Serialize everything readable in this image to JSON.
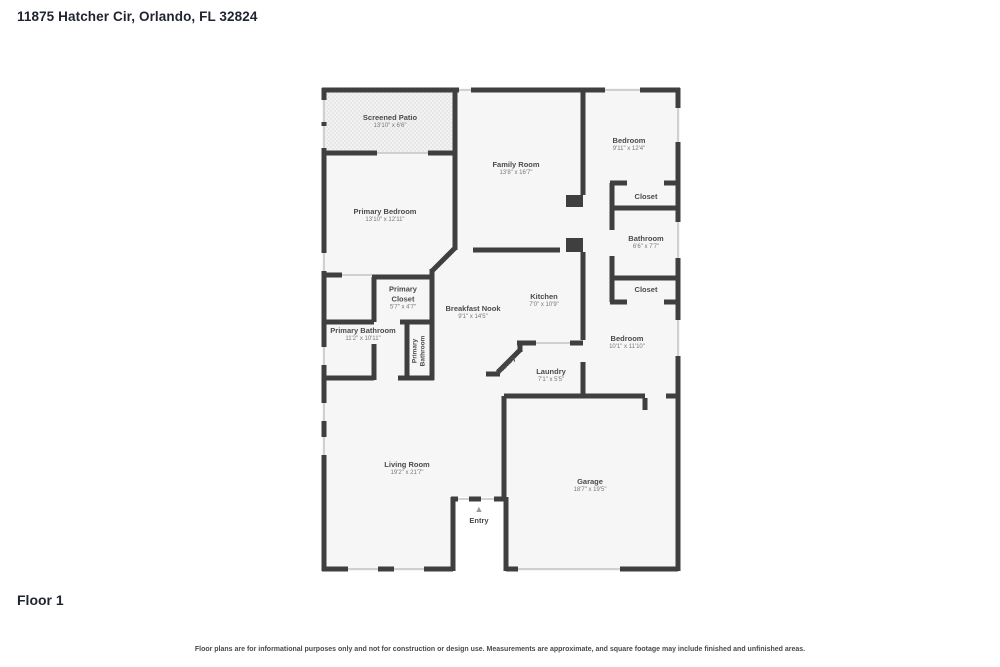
{
  "page": {
    "title": "11875 Hatcher Cir, Orlando, FL 32824",
    "floor_label": "Floor 1",
    "disclaimer": "Floor plans are for informational purposes only and not for construction or design use. Measurements are approximate, and square footage may include finished and unfinished areas."
  },
  "colors": {
    "wall": "#3f3f3f",
    "room_fill": "#f6f6f6",
    "window_line": "#c4c4c4",
    "label_text": "#4b4b4b"
  },
  "floor_plan": {
    "entry_marker": "▲",
    "rooms": [
      {
        "id": "screened-patio",
        "name": "Screened Patio",
        "dims": "13'10\" x 6'6\""
      },
      {
        "id": "family-room",
        "name": "Family Room",
        "dims": "13'8\" x 16'7\""
      },
      {
        "id": "bedroom-top-right",
        "name": "Bedroom",
        "dims": "9'11\" x 12'4\""
      },
      {
        "id": "closet-top-right",
        "name": "Closet",
        "dims": ""
      },
      {
        "id": "bathroom",
        "name": "Bathroom",
        "dims": "6'6\" x 7'7\""
      },
      {
        "id": "closet-mid-right",
        "name": "Closet",
        "dims": ""
      },
      {
        "id": "primary-bedroom",
        "name": "Primary Bedroom",
        "dims": "13'10\" x 12'11\""
      },
      {
        "id": "primary-closet",
        "name": "Primary Closet",
        "dims": "5'7\" x 4'7\""
      },
      {
        "id": "breakfast-nook",
        "name": "Breakfast Nook",
        "dims": "9'1\" x 14'5\""
      },
      {
        "id": "kitchen",
        "name": "Kitchen",
        "dims": "7'0\" x 10'9\""
      },
      {
        "id": "primary-bathroom",
        "name": "Primary Bathroom",
        "dims": "11'2\" x 10'11\""
      },
      {
        "id": "primary-bathroom-corridor",
        "name": "Primary Bathroom",
        "dims": ""
      },
      {
        "id": "pantry",
        "name": "Pantry",
        "dims": ""
      },
      {
        "id": "laundry",
        "name": "Laundry",
        "dims": "7'1\" x 5'5\""
      },
      {
        "id": "bedroom-right",
        "name": "Bedroom",
        "dims": "10'1\" x 11'10\""
      },
      {
        "id": "living-room",
        "name": "Living Room",
        "dims": "19'2\" x 21'7\""
      },
      {
        "id": "garage",
        "name": "Garage",
        "dims": "18'7\" x 19'5\""
      },
      {
        "id": "entry",
        "name": "Entry",
        "dims": ""
      }
    ]
  }
}
